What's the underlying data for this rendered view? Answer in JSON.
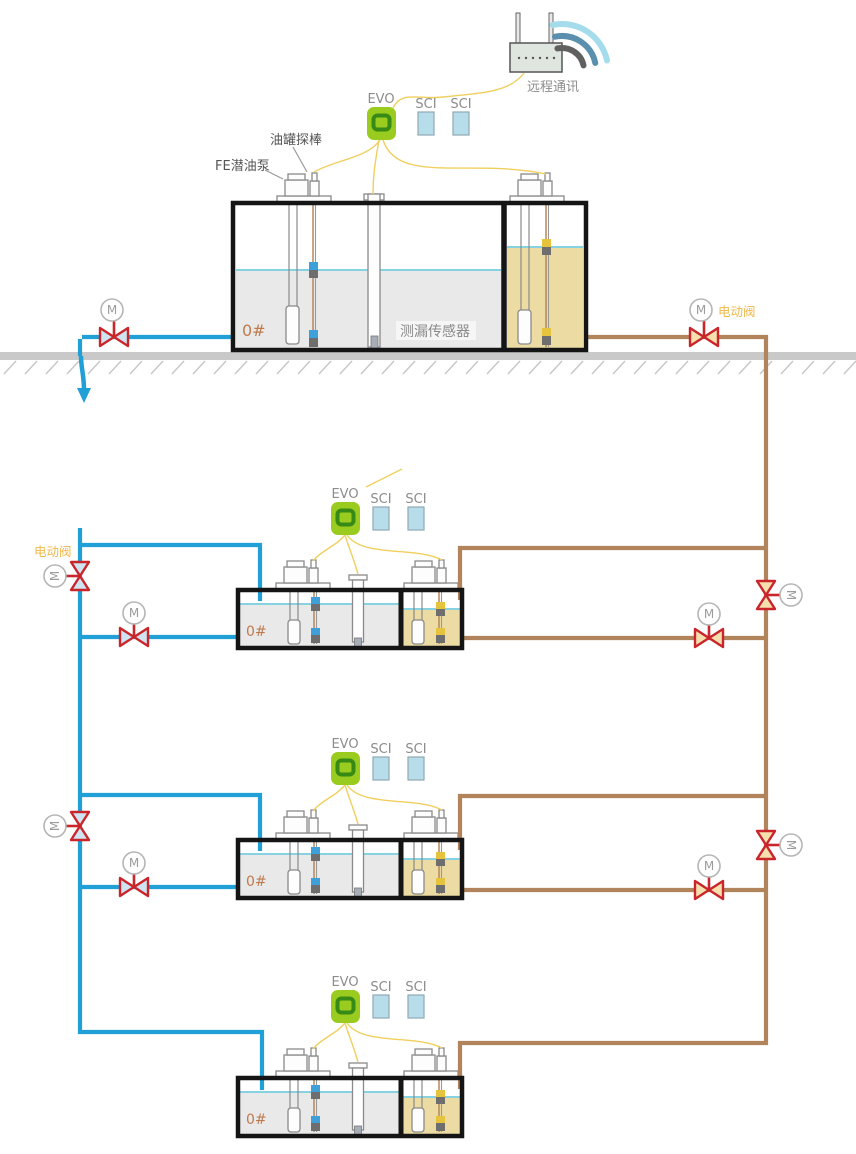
{
  "labels": {
    "remote_comm": "远程通讯",
    "electric_valve": "电动阀",
    "tank_probe": "油罐探棒",
    "fe_pump": "FE潜油泵",
    "leak_sensor": "测漏传感器",
    "controller": "EVO",
    "interface_module": "SCI",
    "fuel_grade": "0#",
    "motor_valve": "M"
  },
  "colors": {
    "supply_pipe_blue": "#219fd7",
    "return_pipe_brown": "#b2845c",
    "signal_wire_yellow": "#f0cf5e",
    "valve_red": "#c9252b",
    "valve_fill_blue": "#cfe4f0",
    "valve_fill_tan": "#f6dfae",
    "evo_green": "#9acb1f",
    "evo_ring_green": "#378a16",
    "sci_blue": "#b7dcea",
    "liquid_gray": "#e9e9e9",
    "liquid_yellow": "#ecdca4",
    "liquid_level_cyan": "#86d2e2",
    "fuel_grade_text": "#bf7a4e",
    "electric_valve_text": "#efb94a",
    "label_gray": "#8c8c8c",
    "tank_border": "#151515",
    "ground_gray": "#c9c9c9"
  }
}
